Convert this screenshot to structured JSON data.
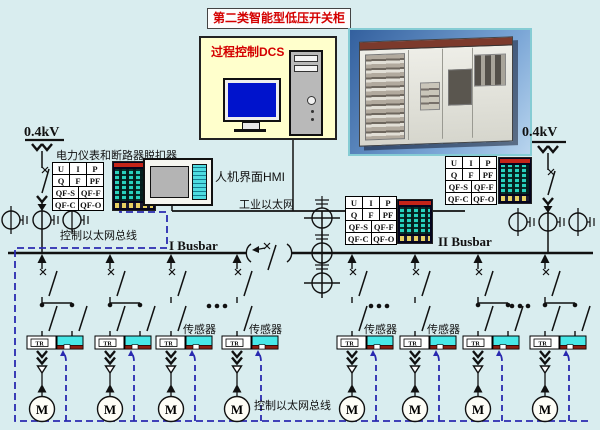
{
  "page": {
    "title": "第二类智能型低压开关柜"
  },
  "dcs": {
    "label": "过程控制DCS"
  },
  "hmi": {
    "label": "人机界面HMI"
  },
  "network": {
    "industrial_ethernet": "工业以太网",
    "control_bus_left": "控制以太网总线",
    "control_bus_bottom": "控制以太网总线"
  },
  "power": {
    "voltage_left": "0.4kV",
    "voltage_right": "0.4kV",
    "busbar_1": "I Busbar",
    "busbar_2": "II Busbar",
    "meter_header": "电力仪表和断路器脱扣器"
  },
  "meter_table": {
    "cells": [
      "U",
      "I",
      "P",
      "Q",
      "F",
      "PF"
    ],
    "qf_cells": [
      "QF-S",
      "QF-F",
      "QF-C",
      "QF-O"
    ]
  },
  "schematic": {
    "sensor_label": "传感器",
    "motor_label": "M",
    "tr_label": "TR"
  },
  "colors": {
    "accent_red": "#d40000",
    "control_bus_blue": "#2a2ab0",
    "sensor_cyan": "#48e8e8",
    "sensor_dark_red": "#8b1f12",
    "monitor_screen_blue": "#0013cc"
  }
}
